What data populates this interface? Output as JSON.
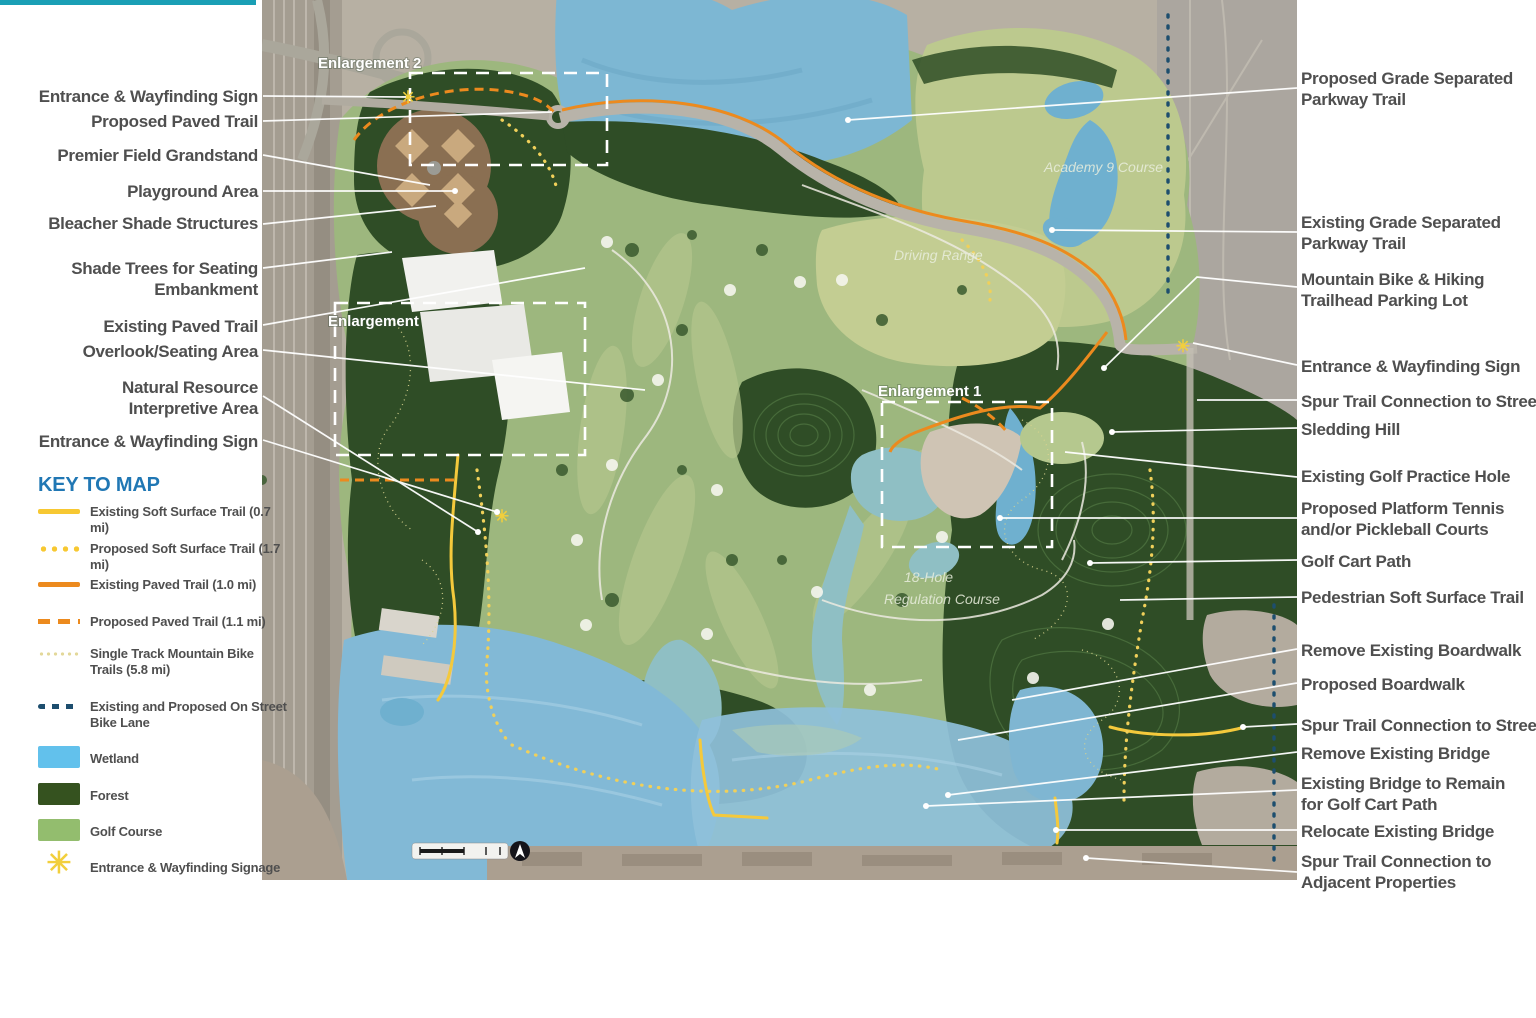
{
  "page": {
    "background": "#ffffff",
    "title_strip_color": "#1a9fb5"
  },
  "left_labels": [
    {
      "lines": [
        "Entrance & Wayfinding Sign"
      ]
    },
    {
      "lines": [
        "Proposed Paved Trail"
      ]
    },
    {
      "lines": [
        "Premier Field Grandstand"
      ]
    },
    {
      "lines": [
        "Playground Area"
      ]
    },
    {
      "lines": [
        "Bleacher Shade Structures"
      ]
    },
    {
      "lines": [
        "Shade Trees for Seating",
        "Embankment"
      ]
    },
    {
      "lines": [
        "Existing Paved Trail"
      ]
    },
    {
      "lines": [
        "Overlook/Seating Area"
      ]
    },
    {
      "lines": [
        "Natural Resource",
        "Interpretive Area"
      ]
    },
    {
      "lines": [
        "Entrance & Wayfinding Sign"
      ]
    }
  ],
  "right_labels": [
    {
      "lines": [
        "Proposed Grade Separated",
        "Parkway Trail"
      ]
    },
    {
      "lines": [
        "Existing Grade Separated",
        "Parkway Trail"
      ]
    },
    {
      "lines": [
        "Mountain Bike & Hiking",
        "Trailhead Parking Lot"
      ]
    },
    {
      "lines": [
        "Entrance & Wayfinding Sign"
      ]
    },
    {
      "lines": [
        "Spur Trail Connection to Street"
      ]
    },
    {
      "lines": [
        "Sledding Hill"
      ]
    },
    {
      "lines": [
        "Existing Golf Practice Hole"
      ]
    },
    {
      "lines": [
        "Proposed Platform Tennis",
        "and/or Pickleball Courts"
      ]
    },
    {
      "lines": [
        "Golf Cart Path"
      ]
    },
    {
      "lines": [
        "Pedestrian Soft Surface Trail"
      ]
    },
    {
      "lines": [
        "Remove Existing Boardwalk"
      ]
    },
    {
      "lines": [
        "Proposed Boardwalk"
      ]
    },
    {
      "lines": [
        "Spur Trail Connection to Street"
      ]
    },
    {
      "lines": [
        "Remove Existing Bridge"
      ]
    },
    {
      "lines": [
        "Existing Bridge to Remain",
        "for Golf Cart Path"
      ]
    },
    {
      "lines": [
        "Relocate Existing Bridge"
      ]
    },
    {
      "lines": [
        "Spur Trail Connection to",
        "Adjacent Properties"
      ]
    }
  ],
  "key_to_map": {
    "title": "KEY TO MAP",
    "items": [
      {
        "label": "Existing Soft Surface Trail (0.7 mi)",
        "symbol": "yellow-solid-line",
        "color": "#F7C832"
      },
      {
        "label": "Proposed Soft Surface Trail (1.7 mi)",
        "symbol": "yellow-dotted-line",
        "color": "#F7C832"
      },
      {
        "label": "Existing Paved Trail (1.0 mi)",
        "symbol": "orange-solid-line",
        "color": "#EC8A1E"
      },
      {
        "label": "Proposed Paved Trail (1.1 mi)",
        "symbol": "orange-dashed-line",
        "color": "#EC8A1E"
      },
      {
        "label": "Single Track Mountain Bike Trails (5.8 mi)",
        "symbol": "thin-dotted-line",
        "color": "#E3D89A"
      },
      {
        "label": "Existing and Proposed On Street Bike Lane",
        "symbol": "blue-dashed-line",
        "color": "#1D4E6E"
      },
      {
        "label": "Wetland",
        "symbol": "swatch",
        "color": "#62C1EC"
      },
      {
        "label": "Forest",
        "symbol": "swatch",
        "color": "#35521F"
      },
      {
        "label": "Golf Course",
        "symbol": "swatch",
        "color": "#93BD6E"
      },
      {
        "label": "Entrance & Wayfinding Signage",
        "symbol": "yellow-star",
        "color": "#F2CF3C"
      }
    ]
  },
  "map_labels": {
    "enlargement_2": "Enlargement 2",
    "enlargement_mid": "Enlargement",
    "enlargement_1": "Enlargement 1",
    "driving_range": "Driving Range",
    "academy_9_course": "Academy 9 Course",
    "regulation_course_line1": "18-Hole",
    "regulation_course_line2": "Regulation Course"
  },
  "map_features": {
    "wetland_color": "#82B9D6",
    "forest_color": "#2F4D26",
    "golf_course_color": "#9DB77E",
    "urban_color": "#B7B0A3",
    "paved_trail_color": "#EC8A1E",
    "soft_trail_color": "#F4C93C",
    "bike_lane_color": "#1D4E6E",
    "leader_line_color": "#FFFFFF"
  }
}
